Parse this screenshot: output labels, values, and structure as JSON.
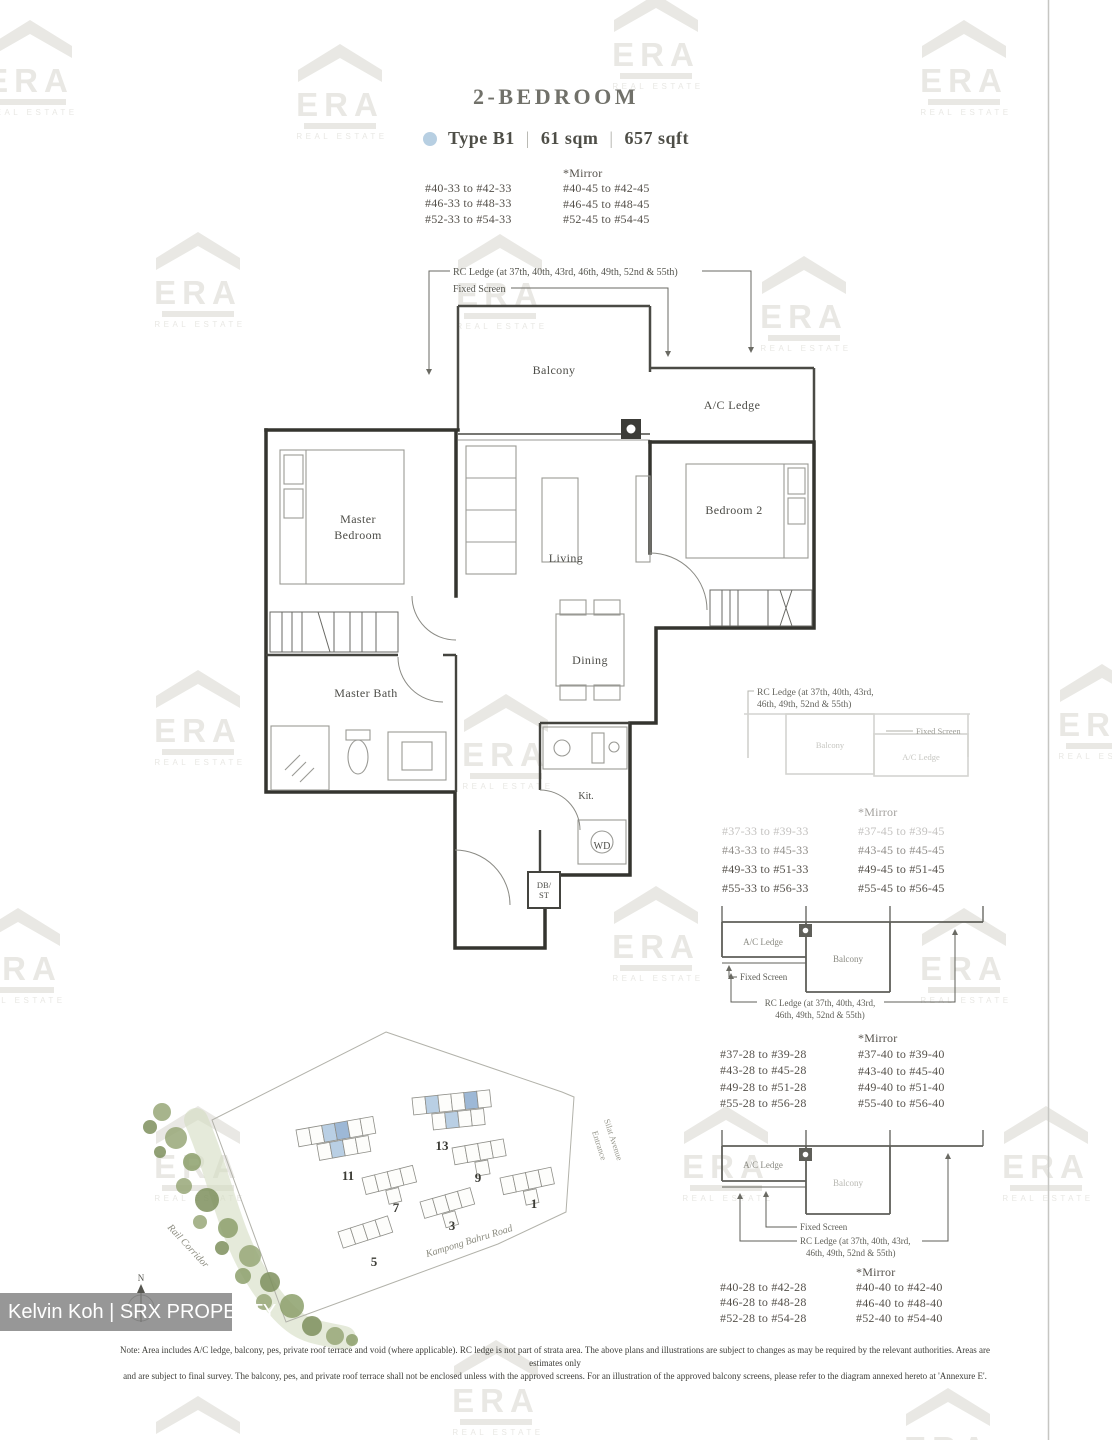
{
  "header": {
    "title": "2-BEDROOM",
    "type_label": "Type B1",
    "area_sqm": "61 sqm",
    "area_sqft": "657 sqft",
    "separator": "|",
    "dot_color": "#b7cfe2"
  },
  "unit_lists": [
    {
      "mirror": "*Mirror",
      "left": [
        "#40-33 to #42-33",
        "#46-33 to #48-33",
        "#52-33 to #54-33"
      ],
      "right": [
        "#40-45 to #42-45",
        "#46-45 to #48-45",
        "#52-45 to #54-45"
      ]
    },
    {
      "mirror": "*Mirror",
      "left": [
        "#37-33 to #39-33",
        "#43-33 to #45-33",
        "#49-33 to #51-33",
        "#55-33 to #56-33"
      ],
      "right": [
        "#37-45 to #39-45",
        "#43-45 to #45-45",
        "#49-45 to #51-45",
        "#55-45 to #56-45"
      ]
    },
    {
      "mirror": "*Mirror",
      "left": [
        "#37-28 to #39-28",
        "#43-28 to #45-28",
        "#49-28 to #51-28",
        "#55-28 to #56-28"
      ],
      "right": [
        "#37-40 to #39-40",
        "#43-40 to #45-40",
        "#49-40 to #51-40",
        "#55-40 to #56-40"
      ]
    },
    {
      "mirror": "*Mirror",
      "left": [
        "#40-28 to #42-28",
        "#46-28 to #48-28",
        "#52-28 to #54-28"
      ],
      "right": [
        "#40-40 to #42-40",
        "#46-40 to #48-40",
        "#52-40 to #54-40"
      ]
    }
  ],
  "floorplan": {
    "rooms": {
      "balcony": "Balcony",
      "ac_ledge": "A/C Ledge",
      "master_line1": "Master",
      "master_line2": "Bedroom",
      "living": "Living",
      "bedroom2": "Bedroom 2",
      "dining": "Dining",
      "master_bath": "Master Bath",
      "kitchen": "Kit.",
      "wd": "WD",
      "db_line1": "DB/",
      "db_line2": "ST"
    },
    "annotations": {
      "rc_ledge": "RC Ledge (at 37th, 40th, 43rd, 46th, 49th, 52nd & 55th)",
      "fixed_screen": "Fixed Screen"
    }
  },
  "diagrams": {
    "ac_ledge": "A/C Ledge",
    "balcony": "Balcony",
    "fixed_screen": "Fixed Screen",
    "rc_line1": "RC Ledge (at 37th, 40th, 43rd,",
    "rc_line2": "46th, 49th, 52nd & 55th)"
  },
  "sitemap": {
    "building_numbers": [
      "11",
      "13",
      "9",
      "7",
      "3",
      "5",
      "1"
    ],
    "labels": {
      "rail_corridor": "Rail Corridor",
      "kampong_bahru": "Kampong Bahru Road",
      "silat_avenue": "Silat Avenue",
      "entrance": "Entrance"
    },
    "compass": "N",
    "highlight_color": "#9db8d6"
  },
  "watermark": {
    "brand": "ERA",
    "brand_sub": "REAL ESTATE"
  },
  "agent_bar": "Kelvin Koh | SRX PROPERTY",
  "footnote": {
    "line1": "Note: Area includes A/C ledge, balcony, pes, private roof terrace and void (where applicable). RC ledge is not part of strata area. The above plans and illustrations are subject to changes as may be required by the relevant authorities. Areas are estimates only",
    "line2": "and are subject to final survey. The balcony, pes, and private roof terrace shall not be enclosed unless with the approved screens. For an illustration of the approved balcony screens, please refer to the diagram annexed hereto at 'Annexure E'."
  }
}
